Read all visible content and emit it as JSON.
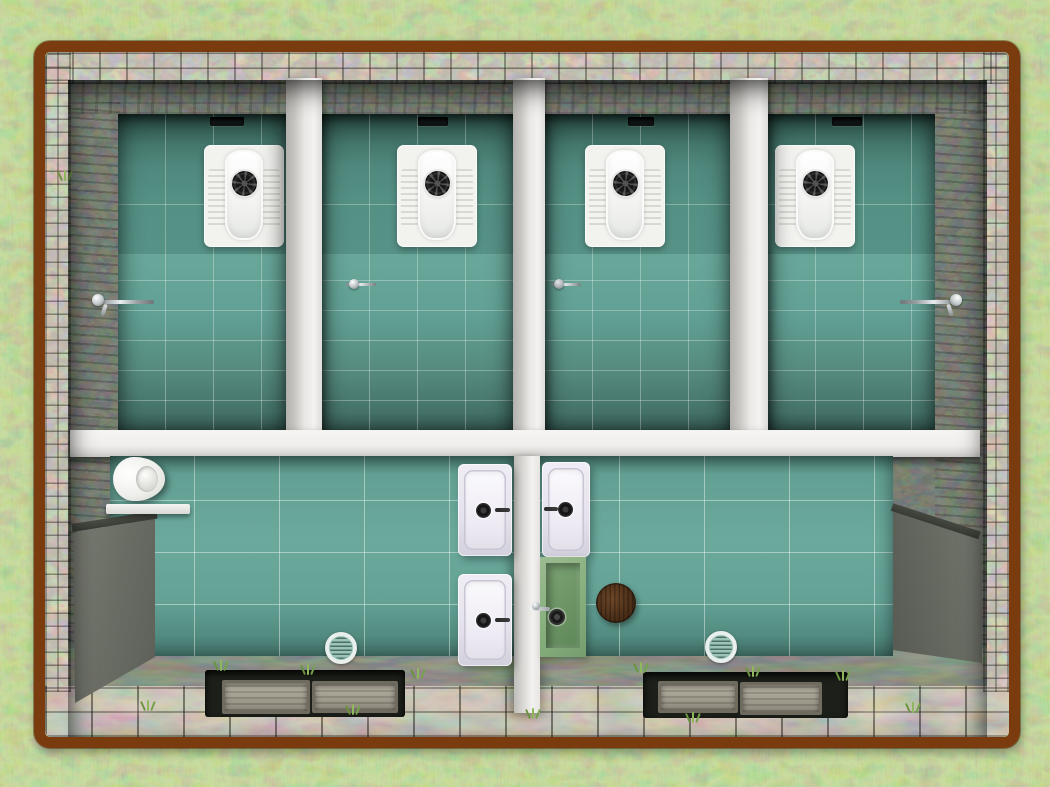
{
  "scene": {
    "title": "Top-view 3D plan of a stone toilet block with four squat-toilet stalls and a shared washroom",
    "counts": {
      "toilet_stalls": 4,
      "squat_toilets": 4,
      "wall_taps": 4,
      "wash_basins": 3,
      "urinals": 1,
      "utility_basin_boxes": 1,
      "wooden_stools": 1,
      "floor_drains": 2,
      "vent_windows": 4,
      "entry_step_pits": 2,
      "privacy_screens": 2
    },
    "colors": {
      "frame_brown": "#7a3b0e",
      "grass_green": "#82a05c",
      "stone_light": "#8d8577",
      "stone_dark": "#2e332c",
      "tile_teal_wall": "#4f877c",
      "tile_teal_floor": "#68a79b",
      "partition_white": "#efeeec",
      "fixture_white": "#f4f4f1",
      "sink_lavender": "#e9e6f0",
      "shelf_green": "#8ab180",
      "screen_gray": "#6b6e65",
      "stool_brown": "#4d3019",
      "paving_slate": "#2c3028"
    }
  }
}
